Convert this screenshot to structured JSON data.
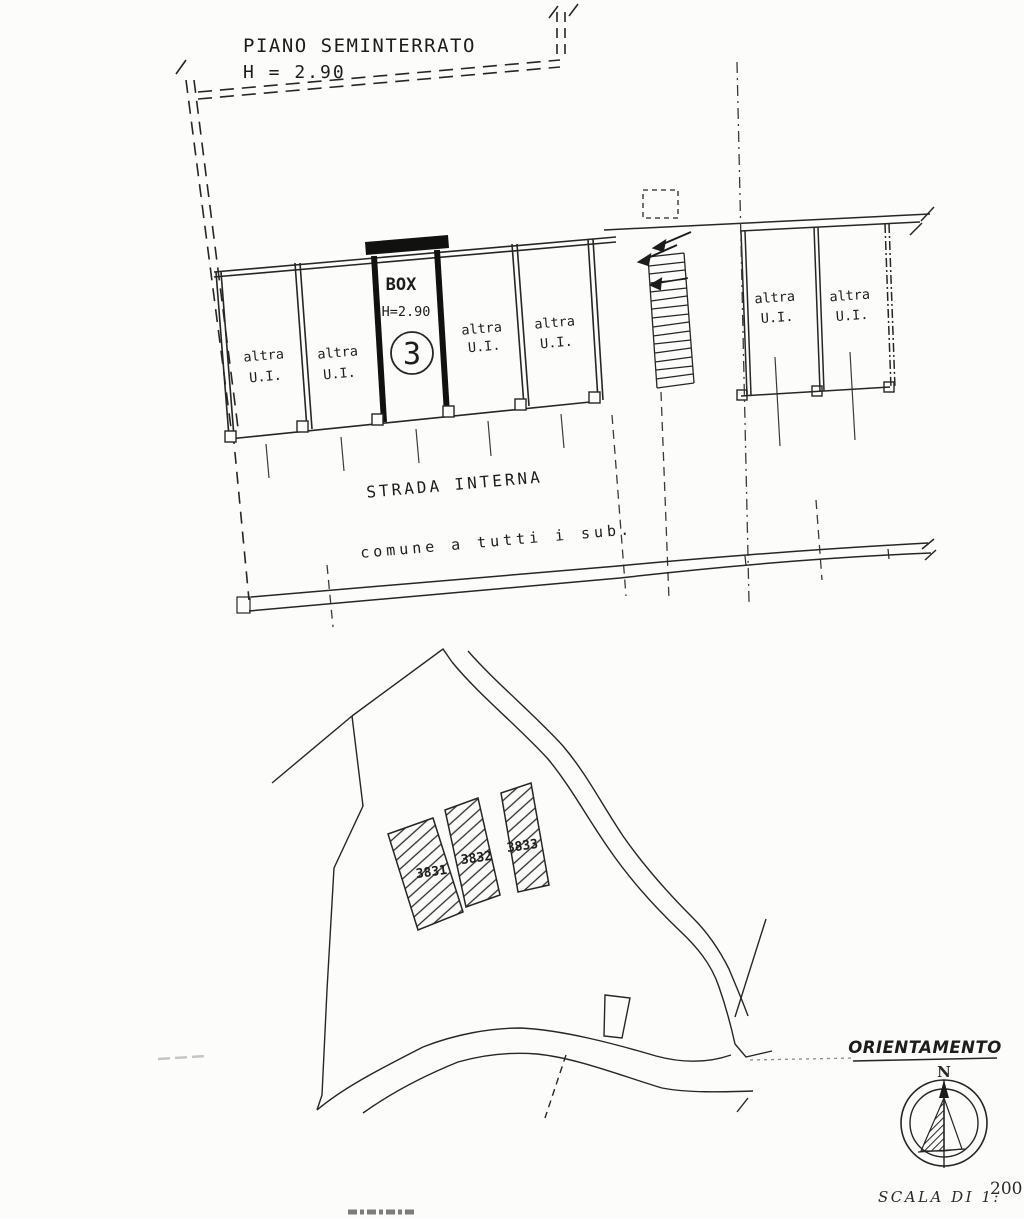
{
  "floor_plan": {
    "title": "PIANO SEMINTERRATO",
    "height_note": "H = 2.90",
    "box": {
      "title": "BOX",
      "height": "H=2.90",
      "number": "3"
    },
    "stalls": [
      {
        "line1": "altra",
        "line2": "U.I."
      },
      {
        "line1": "altra",
        "line2": "U.I."
      },
      {
        "line1": "altra",
        "line2": "U.I."
      },
      {
        "line1": "altra",
        "line2": "U.I."
      },
      {
        "line1": "altra",
        "line2": "U.I."
      },
      {
        "line1": "altra",
        "line2": "U.I."
      }
    ],
    "road_label": "STRADA INTERNA",
    "common_note": "comune a tutti i sub."
  },
  "site_plan": {
    "parcels": [
      {
        "id": "3831"
      },
      {
        "id": "3832"
      },
      {
        "id": "3833"
      }
    ]
  },
  "compass": {
    "title": "ORIENTAMENTO",
    "north": "N"
  },
  "scale_note": {
    "label": "SCALA DI 1:",
    "value": "200"
  },
  "colors": {
    "ink": "#262624",
    "paper": "#fcfcfa"
  }
}
